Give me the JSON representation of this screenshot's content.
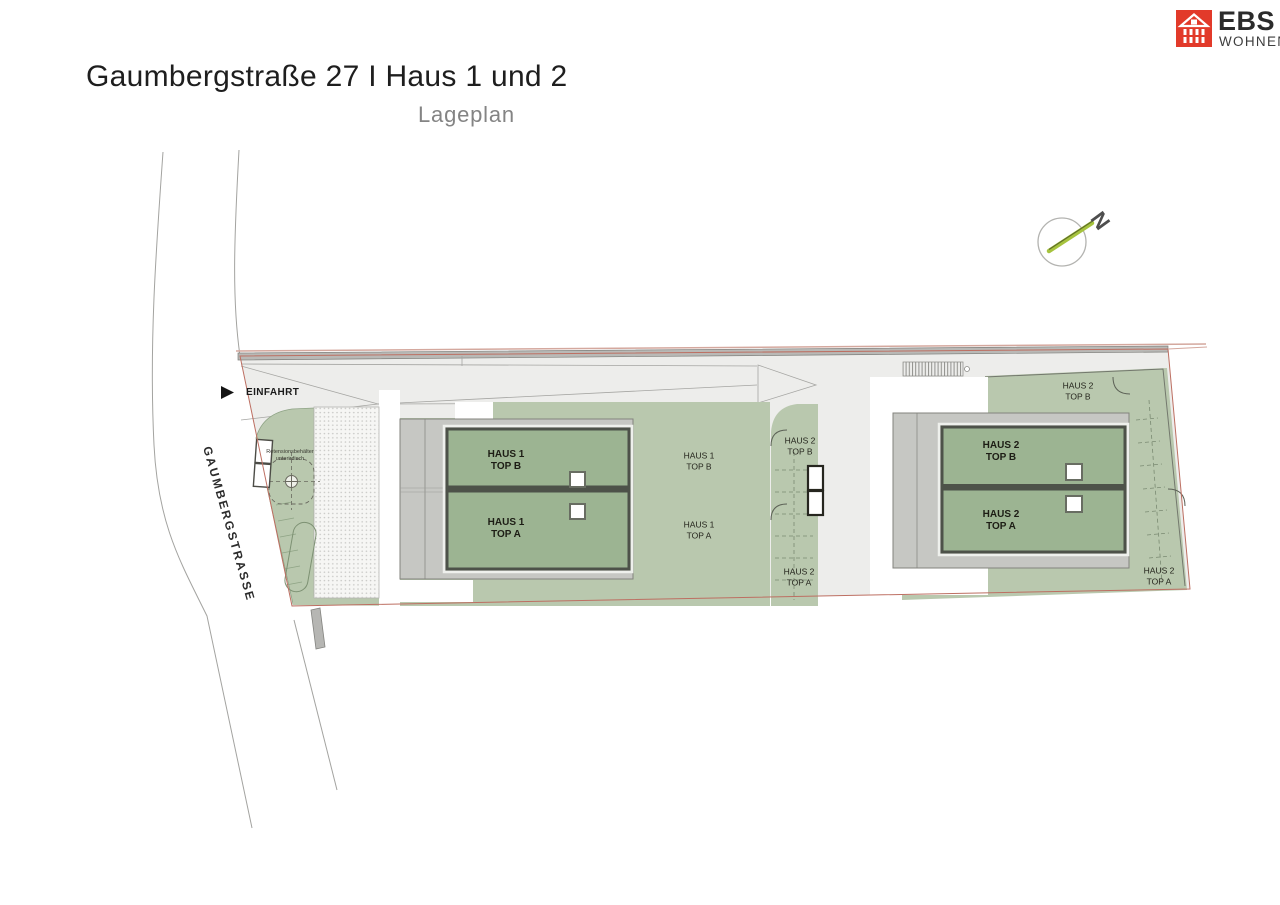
{
  "header": {
    "title": "Gaumbergstraße 27 I Haus 1 und 2",
    "subtitle": "Lageplan"
  },
  "logo": {
    "brand": "EBS",
    "brand_sub": "WOHNEN",
    "brand_color": "#e23a2a"
  },
  "compass": {
    "north_label": "N"
  },
  "plan": {
    "street": "GAUMBERGSTRASSE",
    "entrance": "EINFAHRT",
    "retention": {
      "line1": "Retensionsbehälter",
      "line2": "unterirdisch"
    },
    "haus1": {
      "roof_top_b": {
        "l1": "HAUS 1",
        "l2": "TOP B"
      },
      "roof_top_a": {
        "l1": "HAUS 1",
        "l2": "TOP A"
      },
      "garden_top_b": {
        "l1": "HAUS 1",
        "l2": "TOP B"
      },
      "garden_top_a": {
        "l1": "HAUS 1",
        "l2": "TOP A"
      }
    },
    "haus2": {
      "roof_top_b": {
        "l1": "HAUS 2",
        "l2": "TOP B"
      },
      "roof_top_a": {
        "l1": "HAUS 2",
        "l2": "TOP A"
      },
      "garden_west_top_b": {
        "l1": "HAUS 2",
        "l2": "TOP B"
      },
      "garden_west_top_a": {
        "l1": "HAUS 2",
        "l2": "TOP A"
      },
      "garden_north_top_b": {
        "l1": "HAUS 2",
        "l2": "TOP B"
      },
      "garden_south_top_a": {
        "l1": "HAUS 2",
        "l2": "TOP A"
      }
    },
    "colors": {
      "garden_green": "#b9c8ae",
      "roof_green": "#9cb492",
      "frame_gray": "#c6c7c3",
      "boundary_red": "#bd6f62",
      "site_gray": "#ededeb"
    }
  }
}
